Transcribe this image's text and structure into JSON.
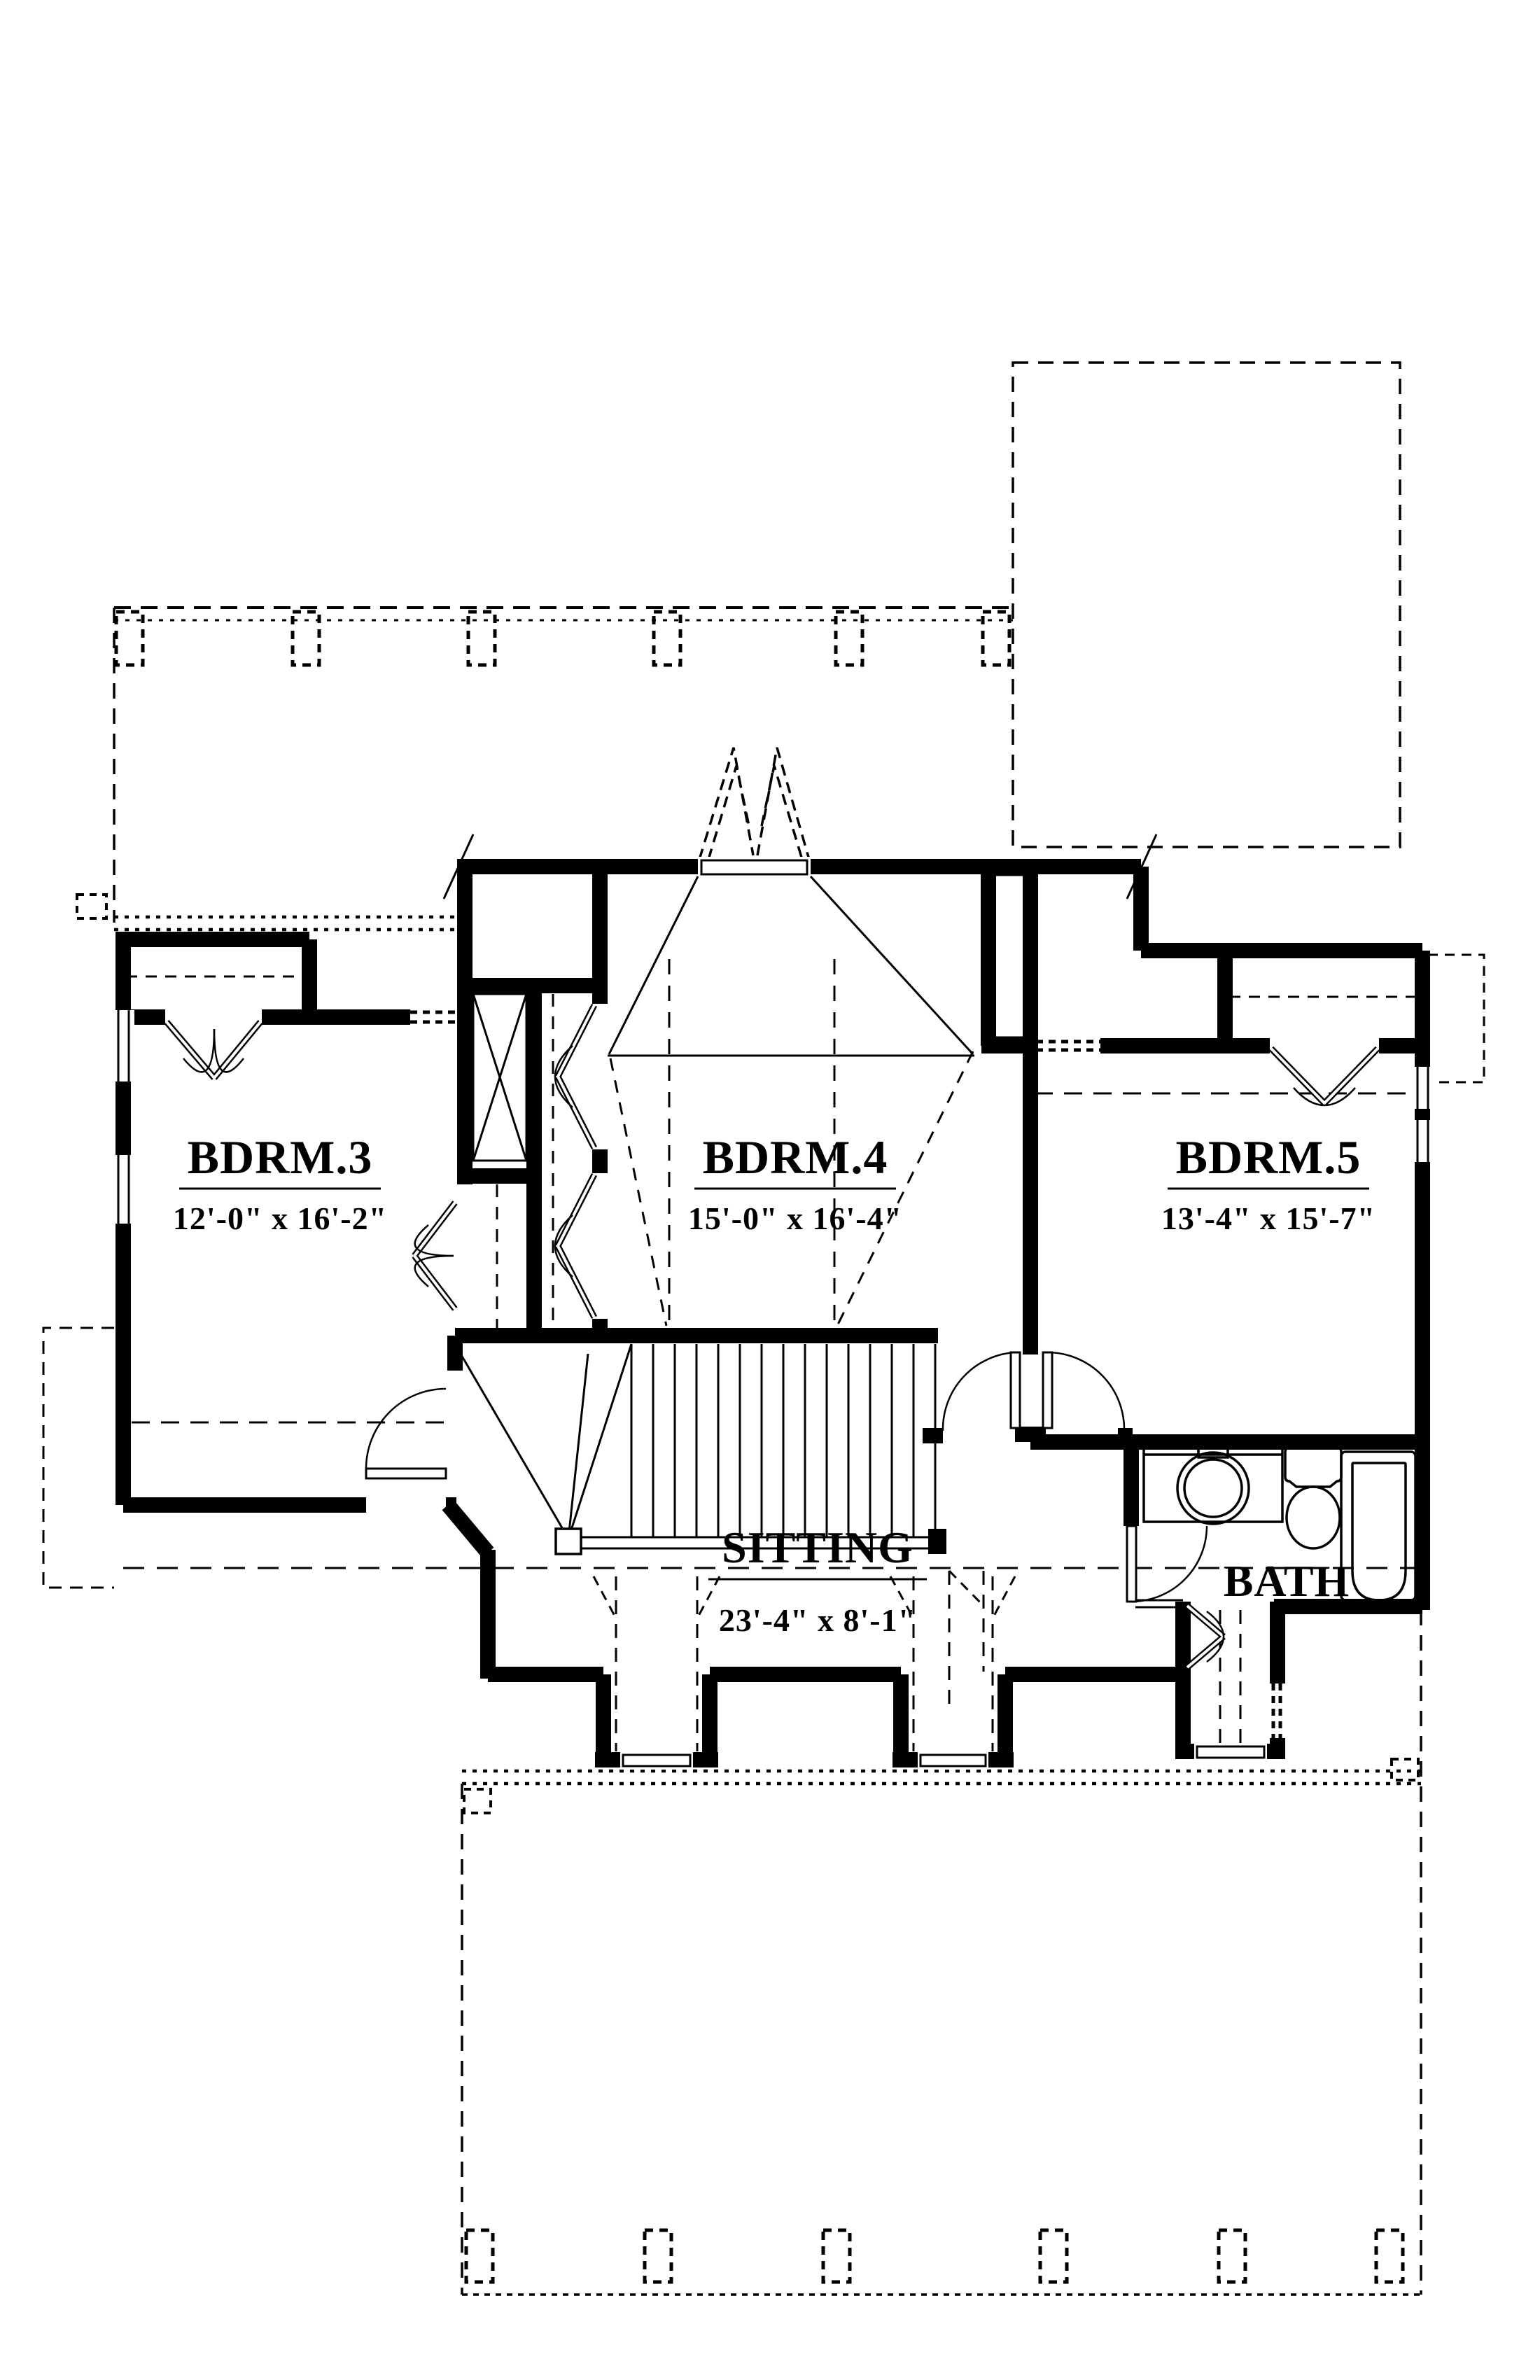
{
  "drawing": {
    "kind": "floor-plan",
    "ink_color": "#000000",
    "paper_color": "#ffffff"
  },
  "rooms": [
    {
      "id": "bdrm3",
      "name": "BDRM.3",
      "dims": "12'-0\" x 16'-2\""
    },
    {
      "id": "bdrm4",
      "name": "BDRM.4",
      "dims": "15'-0\" x 16'-4\""
    },
    {
      "id": "bdrm5",
      "name": "BDRM.5",
      "dims": "13'-4\" x 15'-7\""
    },
    {
      "id": "sitting",
      "name": "SITTING",
      "dims": "23'-4\" x 8'-1\""
    },
    {
      "id": "bath",
      "name": "BATH",
      "dims": ""
    }
  ]
}
